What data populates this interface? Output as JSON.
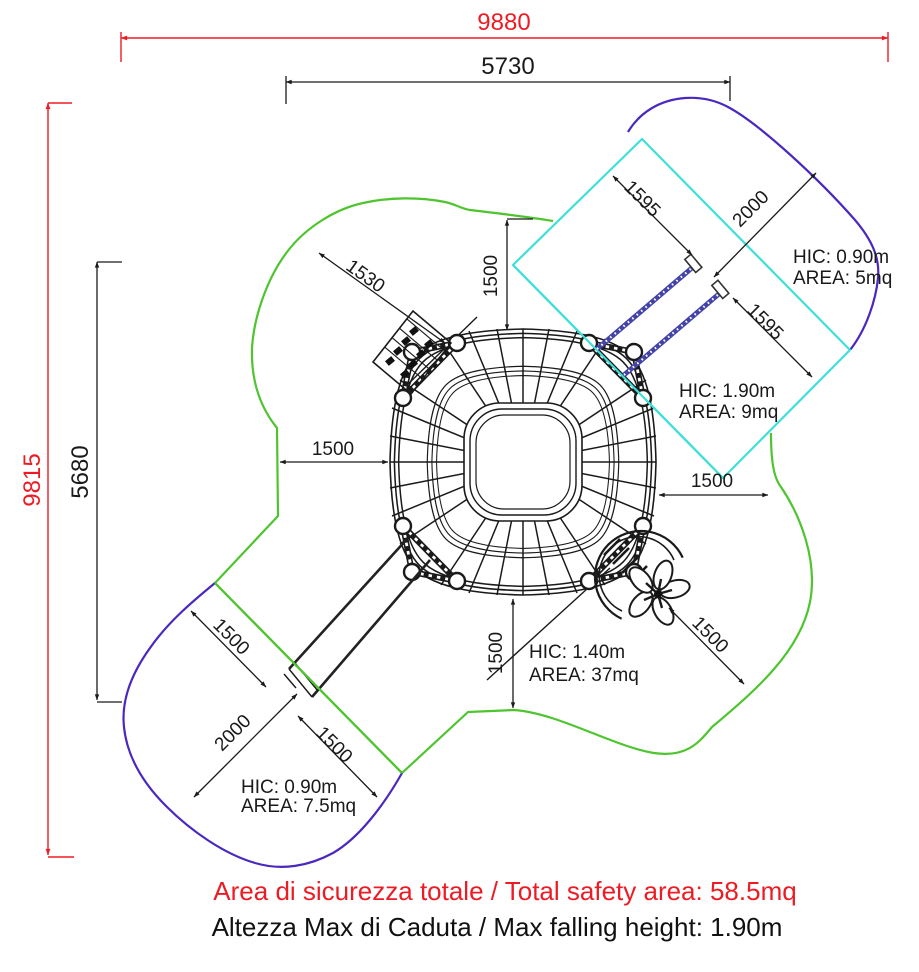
{
  "dimensions": {
    "overall_width": "9880",
    "upper_width": "5730",
    "overall_height": "9815",
    "left_height": "5680",
    "north_clearance": "1500",
    "west_clearance": "1500",
    "east_clearance": "1500",
    "south_clearance": "1500",
    "stairs_clearance": "1530",
    "ne_rail_upper_length": "1595",
    "ne_zone_width": "2000",
    "ne_rail_lower_length": "1595",
    "sw_clearance_upper": "1500",
    "sw_zone_width": "2000",
    "sw_clearance_lower": "1500",
    "se_flower_clearance": "1500"
  },
  "hic_labels": {
    "ne_outer": {
      "hic": "HIC: 0.90m",
      "area": "AREA: 5mq"
    },
    "ne_inner": {
      "hic": "HIC: 1.90m",
      "area": "AREA: 9mq"
    },
    "central": {
      "hic": "HIC: 1.40m",
      "area": "AREA: 37mq"
    },
    "sw": {
      "hic": "HIC: 0.90m",
      "area": "AREA: 7.5mq"
    }
  },
  "footer": {
    "total_safety_area": "Area di sicurezza totale / Total safety area: 58.5mq",
    "max_falling_height": "Altezza Max di Caduta / Max falling height: 1.90m"
  },
  "colors": {
    "dimension_red": "#ed1c24",
    "safety_area_green": "#4ec42f",
    "safety_area_purple": "#4a28c0",
    "equipment_zone_cyan": "#3fdfd9",
    "rail_blue": "#4343a8",
    "drawing_black": "#1a1a1a"
  }
}
